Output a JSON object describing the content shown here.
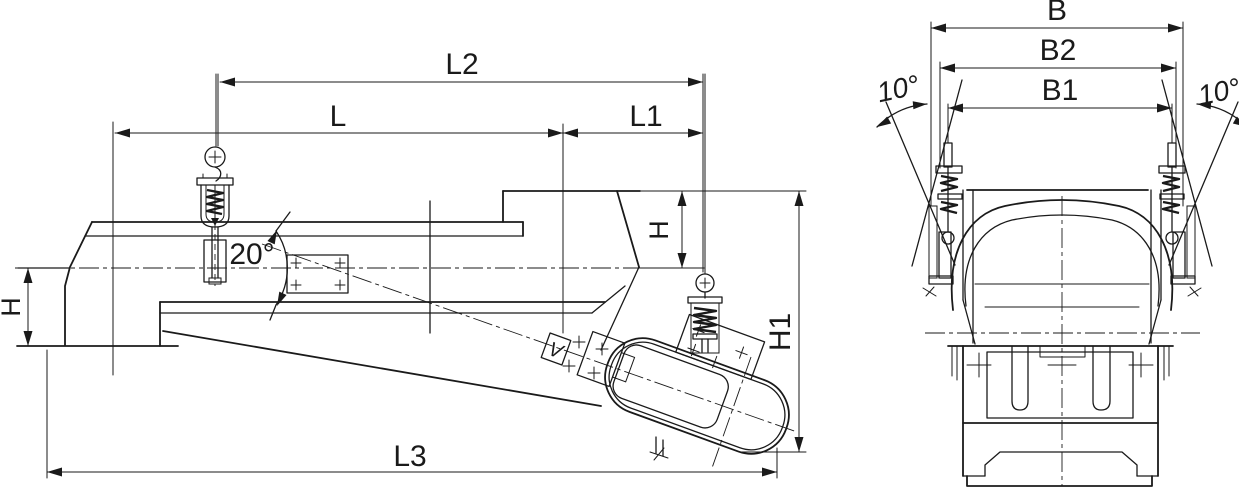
{
  "view_side": {
    "length_top": "L2",
    "length_left": "L",
    "length_right": "L1",
    "length_overall": "L3",
    "height_inlet": "H",
    "height_outlet": "H",
    "height_overall": "H1",
    "incline_angle": "20°",
    "vibration_marker": "V"
  },
  "view_end": {
    "width_overall": "B",
    "width_mid": "B2",
    "width_inner": "B1",
    "sway_angle_left": "10°",
    "sway_angle_right": "10°"
  },
  "colors": {
    "ink": "#1a1a1a",
    "paper": "#ffffff"
  }
}
